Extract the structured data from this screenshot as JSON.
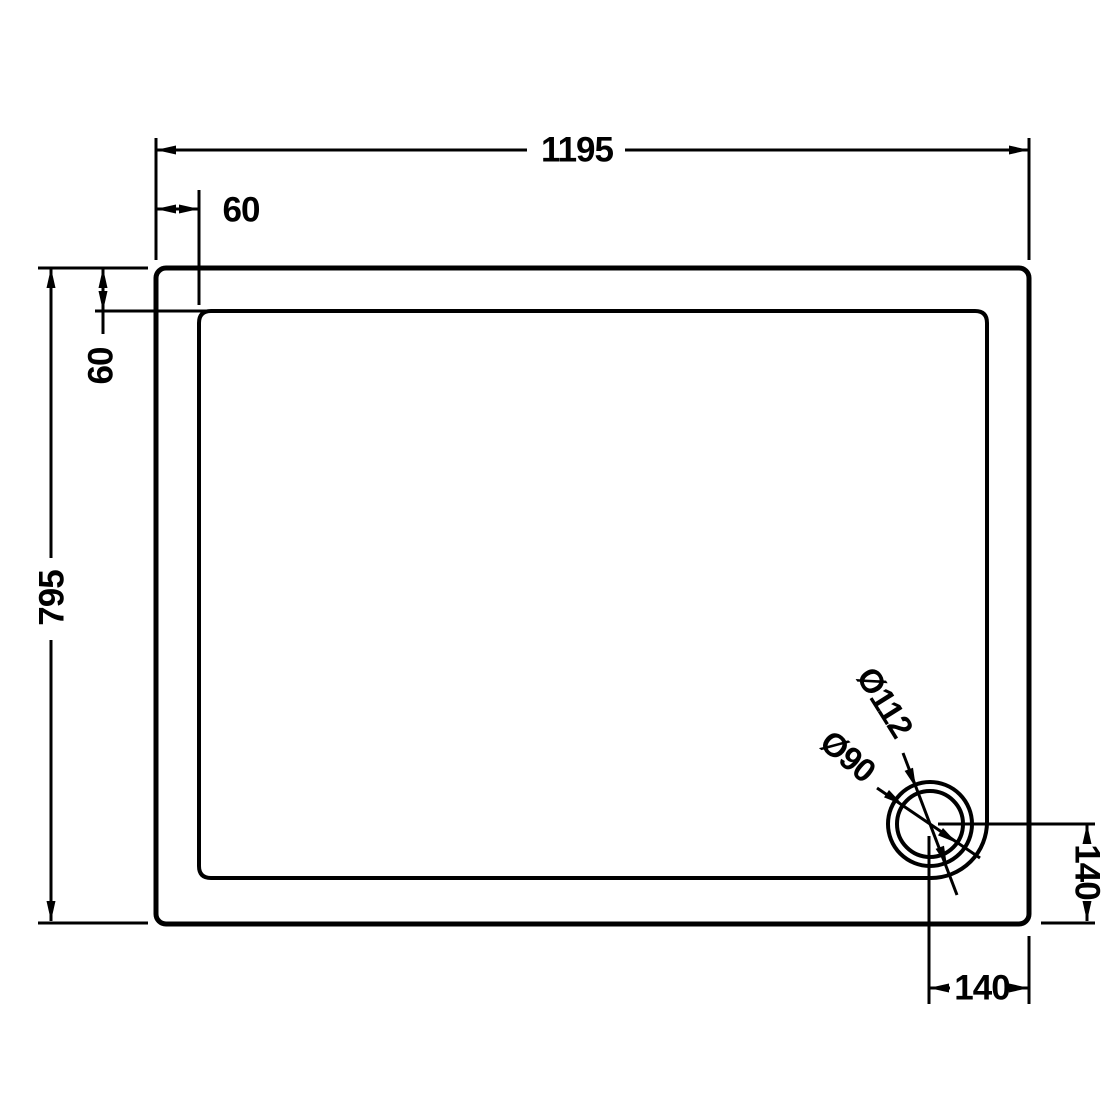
{
  "drawing": {
    "type": "shower-tray-plan-technical-drawing",
    "background_color": "#ffffff",
    "line_color": "#000000",
    "labels": {
      "overall_width": "1195",
      "top_edge_offset": "60",
      "overall_depth": "795",
      "left_edge_offset": "60",
      "waste_outer_diameter": "Ø112",
      "waste_inner_diameter": "Ø90",
      "waste_offset_from_right": "140",
      "waste_offset_from_bottom": "140"
    }
  }
}
